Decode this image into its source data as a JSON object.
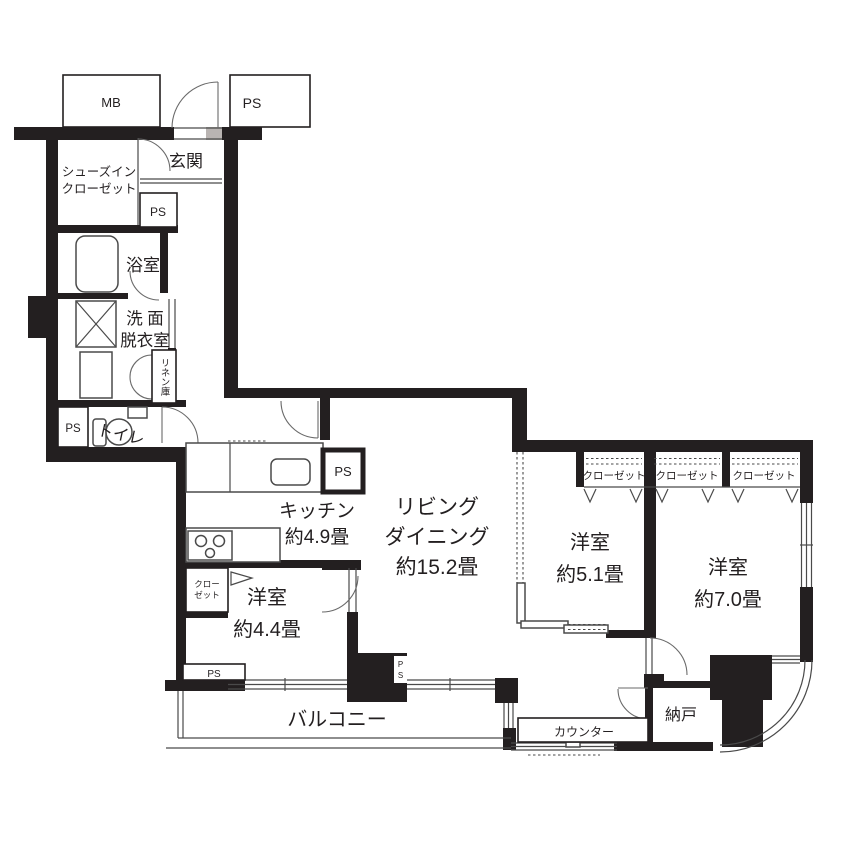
{
  "plan": {
    "type": "apartment-floor-plan",
    "colors": {
      "wall": "#231f20",
      "background": "#ffffff",
      "line": "#4a4a4a"
    },
    "labels": {
      "mb": "MB",
      "ps": "PS",
      "ps_vertical_p": "P",
      "ps_vertical_s": "S",
      "genkan": "玄関",
      "shoes1": "シューズイン",
      "shoes2": "クローゼット",
      "bath": "浴室",
      "wash1": "洗 面",
      "wash2": "脱衣室",
      "linen": "リネン庫",
      "toilet": "トイレ",
      "kitchen1": "キッチン",
      "kitchen2": "約4.9畳",
      "living1": "リビング",
      "living2": "ダイニング",
      "living3": "約15.2畳",
      "bed51_1": "洋室",
      "bed51_2": "約5.1畳",
      "bed70_1": "洋室",
      "bed70_2": "約7.0畳",
      "bed44_1": "洋室",
      "bed44_2": "約4.4畳",
      "closet": "クローゼット",
      "closet_small1": "クロー",
      "closet_small2": "ゼット",
      "balcony": "バルコニー",
      "counter": "カウンター",
      "storage": "納戸"
    },
    "rooms": [
      {
        "name": "リビングダイニング",
        "size": "約15.2畳"
      },
      {
        "name": "キッチン",
        "size": "約4.9畳"
      },
      {
        "name": "洋室",
        "size": "約5.1畳"
      },
      {
        "name": "洋室",
        "size": "約7.0畳"
      },
      {
        "name": "洋室",
        "size": "約4.4畳"
      },
      {
        "name": "浴室",
        "size": ""
      },
      {
        "name": "洗面脱衣室",
        "size": ""
      },
      {
        "name": "トイレ",
        "size": ""
      },
      {
        "name": "玄関",
        "size": ""
      },
      {
        "name": "シューズインクローゼット",
        "size": ""
      },
      {
        "name": "納戸",
        "size": ""
      },
      {
        "name": "バルコニー",
        "size": ""
      }
    ]
  }
}
